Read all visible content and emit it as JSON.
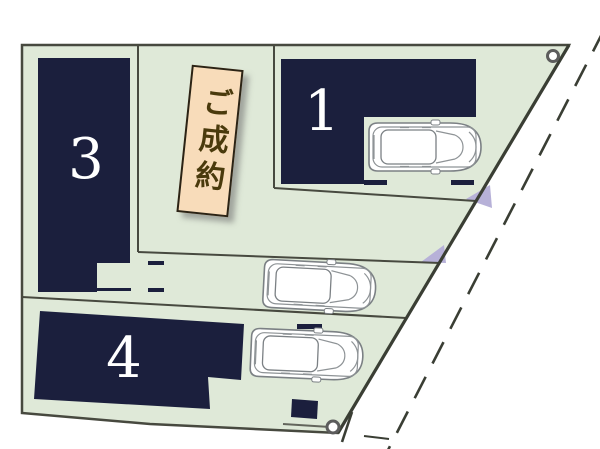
{
  "map": {
    "lots": [
      {
        "label": "1"
      },
      {
        "label": "3"
      },
      {
        "label": "4"
      }
    ],
    "banner": {
      "text": "ご成約"
    },
    "icons": {
      "car": "car-top-view-icon",
      "survey_point": "survey-point-icon"
    },
    "colors": {
      "plot_green": "#dfe9d8",
      "building_navy": "#1b1f3d",
      "line_gray": "#47493f",
      "banner_bg": "#f8dcba",
      "banner_border": "#2b2315",
      "banner_text": "#4a3a0c",
      "road_triangle": "#b7b1d8",
      "label_white": "#ffffff",
      "car_stroke": "#7b8084"
    }
  }
}
